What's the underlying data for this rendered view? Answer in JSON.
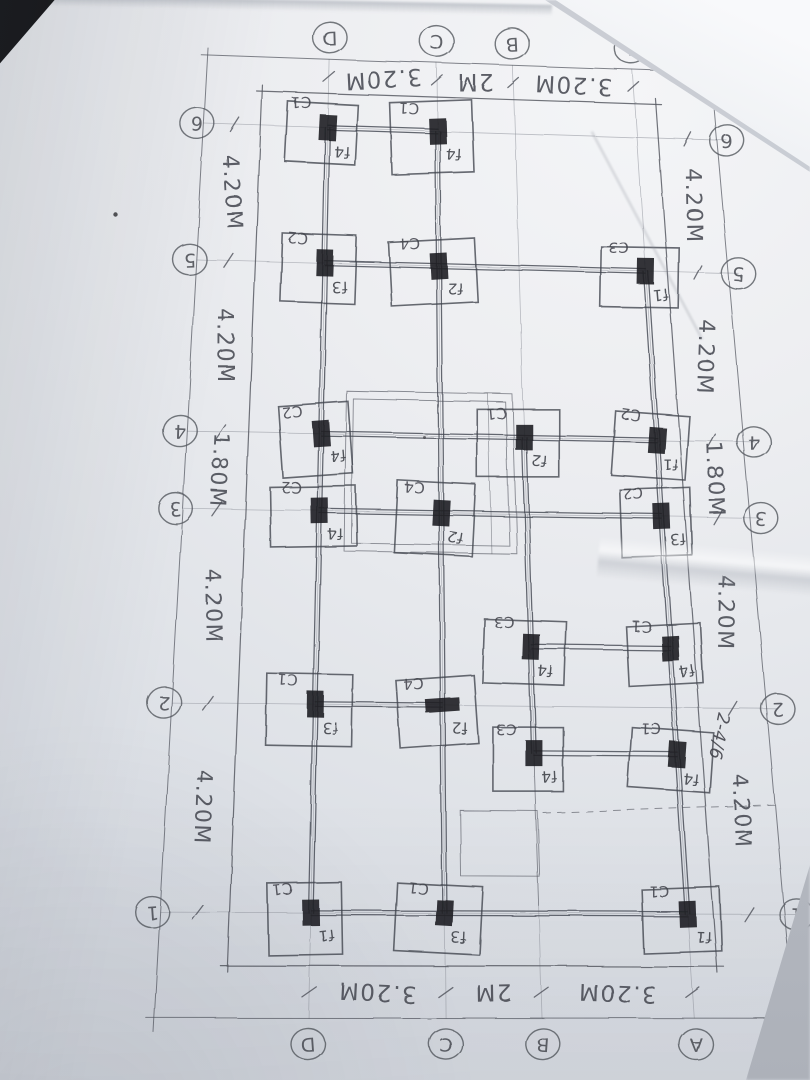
{
  "photo": {
    "surface_color": "#c3c7ce",
    "paper_color": "#e9ebee",
    "pencil_color": "#50535c",
    "column_fill": "#1d1e22"
  },
  "plan": {
    "grid_bubbles": {
      "top": [
        "D",
        "C",
        "B",
        "A"
      ],
      "bottom": [
        "D",
        "C",
        "B",
        "A"
      ],
      "left": [
        "6",
        "5",
        "4",
        "3",
        "2",
        "1"
      ],
      "right": [
        "6",
        "5",
        "4",
        "3",
        "2",
        "1"
      ]
    },
    "dims": {
      "top": [
        {
          "span": "D-C",
          "label": "3.20M"
        },
        {
          "span": "C-B",
          "label": "2M"
        },
        {
          "span": "B-A",
          "label": "3.20M"
        }
      ],
      "bottom": [
        {
          "span": "D-C",
          "label": "3.20M"
        },
        {
          "span": "C-B",
          "label": "2M"
        },
        {
          "span": "B-A",
          "label": "3.20M"
        }
      ],
      "left": [
        {
          "span": "6-5",
          "label": "4.20M"
        },
        {
          "span": "5-4",
          "label": "4.20M"
        },
        {
          "span": "4-3",
          "label": "1.80M"
        },
        {
          "span": "3-2",
          "label": "4.20M"
        },
        {
          "span": "2-1",
          "label": "4.20M"
        }
      ],
      "right": [
        {
          "span": "6-5",
          "label": "4.20M"
        },
        {
          "span": "5-4",
          "label": "4.20M"
        },
        {
          "span": "4-3",
          "label": "1.80M"
        },
        {
          "span": "3-2",
          "label": "4.20M"
        },
        {
          "span": "2-1",
          "label": "4.20M"
        }
      ]
    },
    "annotation": {
      "text": "2-4/6",
      "location": "right dimension band between rows 3 and 2"
    },
    "footings": [
      {
        "col": "D",
        "row": "6",
        "column_mark": "C1",
        "footing_mark": "f4"
      },
      {
        "col": "C",
        "row": "6",
        "column_mark": "C1",
        "footing_mark": "f4"
      },
      {
        "col": "D",
        "row": "5",
        "column_mark": "C2",
        "footing_mark": "f3"
      },
      {
        "col": "C",
        "row": "5",
        "column_mark": "C4",
        "footing_mark": "f2"
      },
      {
        "col": "A",
        "row": "5",
        "column_mark": "C3",
        "footing_mark": "f1"
      },
      {
        "col": "D",
        "row": "4",
        "column_mark": "C2",
        "footing_mark": "f4"
      },
      {
        "col": "B",
        "row": "4",
        "column_mark": "C1",
        "footing_mark": "f2"
      },
      {
        "col": "A",
        "row": "4",
        "column_mark": "C2",
        "footing_mark": "f1"
      },
      {
        "col": "D",
        "row": "3",
        "column_mark": "C2",
        "footing_mark": "f4"
      },
      {
        "col": "C",
        "row": "3",
        "column_mark": "C4",
        "footing_mark": "f2"
      },
      {
        "col": "A",
        "row": "3",
        "column_mark": "C2",
        "footing_mark": "f3"
      },
      {
        "col": "B",
        "row": "2.5",
        "column_mark": "C3",
        "footing_mark": "f4"
      },
      {
        "col": "A",
        "row": "2.5",
        "column_mark": "C1",
        "footing_mark": "f4"
      },
      {
        "col": "D",
        "row": "2",
        "column_mark": "C1",
        "footing_mark": "f3"
      },
      {
        "col": "C",
        "row": "2",
        "column_mark": "C4",
        "footing_mark": "f2",
        "smudge": "h"
      },
      {
        "col": "B",
        "row": "2b",
        "column_mark": "C3",
        "footing_mark": "f4"
      },
      {
        "col": "A",
        "row": "2b",
        "column_mark": "C1",
        "footing_mark": "f4"
      },
      {
        "col": "D",
        "row": "1",
        "column_mark": "C1",
        "footing_mark": "f1"
      },
      {
        "col": "C",
        "row": "1",
        "column_mark": "C1",
        "footing_mark": "f3"
      },
      {
        "col": "A",
        "row": "1",
        "column_mark": "C1",
        "footing_mark": "f1"
      }
    ],
    "beams": {
      "horizontal": [
        {
          "row": "6",
          "from": "D",
          "to": "C"
        },
        {
          "row": "5",
          "from": "D",
          "to": "A"
        },
        {
          "row": "4",
          "from": "D",
          "to": "A"
        },
        {
          "row": "3",
          "from": "D",
          "to": "A"
        },
        {
          "row": "2.5",
          "from": "B",
          "to": "A"
        },
        {
          "row": "2",
          "from": "D",
          "to": "C"
        },
        {
          "row": "2b",
          "from": "B",
          "to": "A"
        },
        {
          "row": "1",
          "from": "D",
          "to": "A"
        }
      ],
      "vertical": [
        {
          "col": "D",
          "from": "6",
          "to": "1"
        },
        {
          "col": "C",
          "from": "6",
          "to": "1"
        },
        {
          "col": "B",
          "from": "4",
          "to": "2b"
        },
        {
          "col": "A",
          "from": "5",
          "to": "1"
        }
      ]
    }
  }
}
